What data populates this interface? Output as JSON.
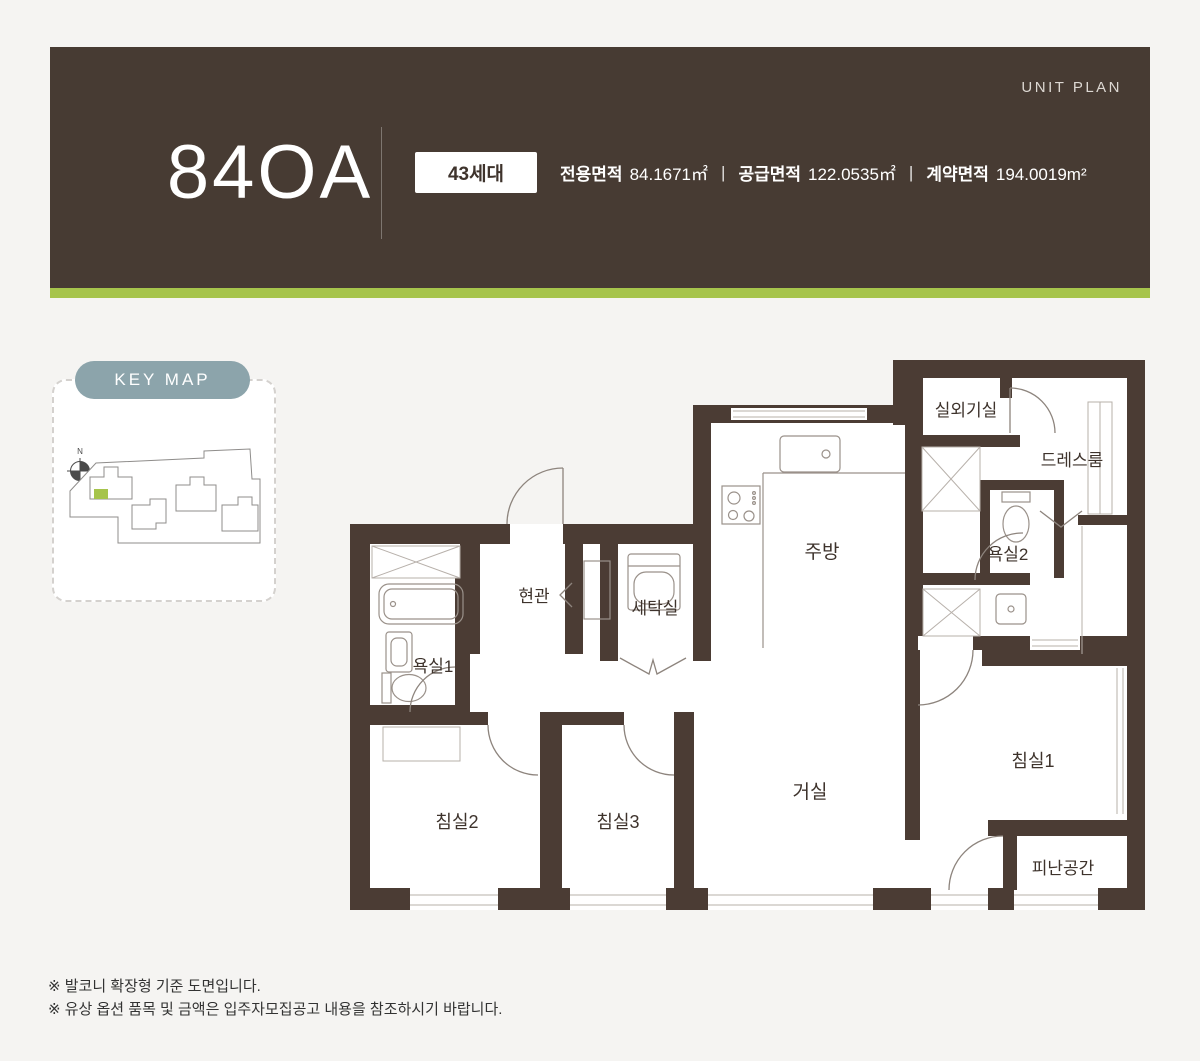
{
  "header": {
    "unit_plan_label": "UNIT PLAN",
    "unit_name": "84OA",
    "badge": "43세대",
    "separator": "|",
    "areas": [
      {
        "label": "전용면적",
        "value": "84.1671㎡"
      },
      {
        "label": "공급면적",
        "value": "122.0535㎡"
      },
      {
        "label": "계약면적",
        "value": "194.0019m²"
      }
    ],
    "colors": {
      "background": "#473b33",
      "accent_stripe": "#a6c44c"
    }
  },
  "keymap": {
    "label": "KEY MAP",
    "north": "N",
    "pill_color": "#8ca4ab",
    "highlight_color": "#a6c44c"
  },
  "floorplan": {
    "wall_color": "#4b3c34",
    "rooms": {
      "outdoor_unit": "실외기실",
      "dressroom": "드레스룸",
      "bath2": "욕실2",
      "kitchen": "주방",
      "entrance": "현관",
      "laundry": "세탁실",
      "bath1": "욕실1",
      "bed2": "침실2",
      "bed3": "침실3",
      "living": "거실",
      "bed1": "침실1",
      "refuge": "피난공간"
    }
  },
  "notes": [
    "※ 발코니 확장형 기준 도면입니다.",
    "※ 유상 옵션 품목 및 금액은 입주자모집공고 내용을 참조하시기 바랍니다."
  ]
}
